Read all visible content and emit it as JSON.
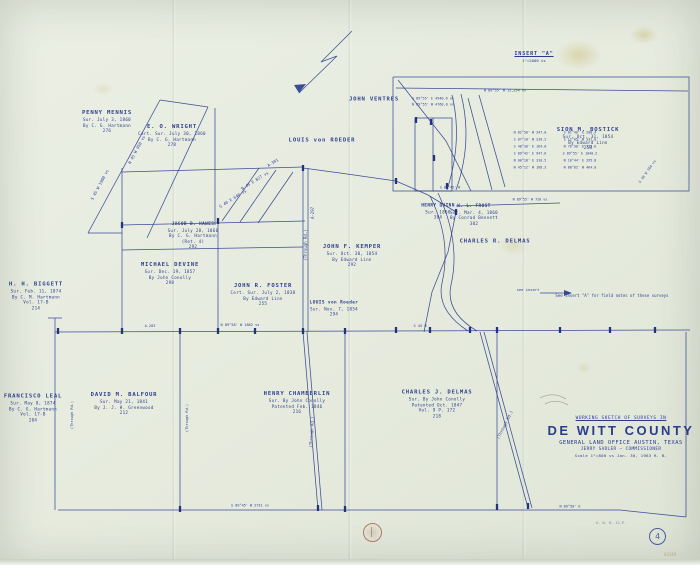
{
  "colors": {
    "paper": "#e8ecdf",
    "ink": "#2e3f8e",
    "red_seal": "#a2543a",
    "stain": "#c4af5f"
  },
  "title_block": {
    "line1": "WORKING SKETCH OF SURVEYS IN",
    "county": "DE WITT  COUNTY",
    "office": "GENERAL LAND OFFICE    AUSTIN, TEXAS",
    "commissioner": "JERRY SADLER — COMMISSIONER",
    "scale_note": "Scale 1\"=800 vs    Jan. 30, 1963    R. B."
  },
  "insert": {
    "label": "INSERT \"A\"",
    "scale": "1\"=2000 vs"
  },
  "footer": {
    "sheet_number": "4",
    "under_border_note": "A. W. B.   12-P.",
    "corner_code": "63249"
  },
  "survey_labels": [
    {
      "x": 107,
      "y": 122,
      "name": "PENNY MENNIS",
      "lines": [
        "Sur. July 3, 1860",
        "By C. G. Hartmann",
        "276"
      ]
    },
    {
      "x": 172,
      "y": 136,
      "name": "E. O. WRIGHT",
      "lines": [
        "Cert. Sur. July 30, 1860",
        "By C. G. Hartmann",
        "278"
      ]
    },
    {
      "x": 193,
      "y": 236,
      "name": "JACOB B. HAWES",
      "lines": [
        "Sur. July 28, 1860",
        "By C. G. Hartmann",
        "(Ret. 4)",
        "292"
      ],
      "small": true
    },
    {
      "x": 170,
      "y": 274,
      "name": "MICHAEL DEVINE",
      "lines": [
        "Sur. Dec. 19, 1857",
        "By John Conolly",
        "298"
      ]
    },
    {
      "x": 263,
      "y": 295,
      "name": "JOHN R. FOSTER",
      "lines": [
        "Cert. Sur. July 2, 1838",
        "By Edward Linn",
        "255"
      ]
    },
    {
      "x": 352,
      "y": 256,
      "name": "JOHN F. KEMPER",
      "lines": [
        "Sur. Oct. 30, 1854",
        "By Edward Linn",
        "292"
      ]
    },
    {
      "x": 322,
      "y": 141,
      "name": "LOUIS von ROEDER",
      "lines": []
    },
    {
      "x": 374,
      "y": 100,
      "name": "JOHN VENTRES",
      "lines": []
    },
    {
      "x": 334,
      "y": 309,
      "name": "LOUIS von Roeder",
      "lines": [
        "Sur. Nov. 7, 1854",
        "294"
      ],
      "small": true
    },
    {
      "x": 36,
      "y": 296,
      "name": "H. H. BIGGETT",
      "lines": [
        "Sur. Feb. 11, 1874",
        "By C. M. Hartmann",
        "Vol. 17-B",
        "214"
      ]
    },
    {
      "x": 33,
      "y": 408,
      "name": "FRANCISCO LEAL",
      "lines": [
        "Sur. May 8, 1874",
        "By C. G. Hartmann",
        "Vol. 17-B",
        "204"
      ]
    },
    {
      "x": 124,
      "y": 404,
      "name": "DAVID M. BALFOUR",
      "lines": [
        "Sur. May 21, 1841",
        "By J. J. H. Greenwood",
        "212"
      ]
    },
    {
      "x": 297,
      "y": 403,
      "name": "HENRY CHAMBERLIN",
      "lines": [
        "Sur. By John Conolly",
        "Patented Feb. 1846",
        "216"
      ]
    },
    {
      "x": 437,
      "y": 404,
      "name": "CHARLES J. DELMAS",
      "lines": [
        "Sur. By John Conolly",
        "Patented Oct. 1847",
        "Vol. 9 P. 172",
        "218"
      ]
    },
    {
      "x": 495,
      "y": 242,
      "name": "CHARLES R. DELMAS",
      "lines": []
    },
    {
      "x": 588,
      "y": 139,
      "name": "SION M. BOSTICK",
      "lines": [
        "Sur. Oct. 31, 1854",
        "By Edward Linn",
        "258"
      ]
    },
    {
      "x": 474,
      "y": 215,
      "name": "W. L. FROST",
      "lines": [
        "Sur. Mar. 4, 1860",
        "By Conrad Bennett",
        "302"
      ],
      "small": true
    },
    {
      "x": 438,
      "y": 212,
      "name": "HENRY QUINN",
      "lines": [
        "Sur. 1860",
        "304"
      ],
      "small": true
    }
  ],
  "micro_labels": [
    {
      "x": 100,
      "y": 185,
      "r": -62,
      "t": "S 45 W 1900 vs"
    },
    {
      "x": 137,
      "y": 150,
      "r": -62,
      "t": "N 45 W 950 vs"
    },
    {
      "x": 233,
      "y": 199,
      "r": -32,
      "t": "S 40 E 640 vs"
    },
    {
      "x": 255,
      "y": 181,
      "r": -32,
      "t": "N 49 E 827 vs"
    },
    {
      "x": 273,
      "y": 163,
      "r": -32,
      "t": "A-301"
    },
    {
      "x": 306,
      "y": 245,
      "r": -90,
      "t": "(Through Rd.)"
    },
    {
      "x": 313,
      "y": 213,
      "r": -90,
      "t": "A-297"
    },
    {
      "x": 240,
      "y": 326,
      "r": 0,
      "t": "N 89°58' W 1862 vs",
      "s": 3.6
    },
    {
      "x": 150,
      "y": 327,
      "r": 0,
      "t": "A-283",
      "s": 3.6
    },
    {
      "x": 420,
      "y": 327,
      "r": 0,
      "t": "S 45 W",
      "s": 3.6
    },
    {
      "x": 312,
      "y": 432,
      "r": -86,
      "t": "(Through Rd.)"
    },
    {
      "x": 505,
      "y": 425,
      "r": -63,
      "t": "(Through Rd.)"
    },
    {
      "x": 73,
      "y": 415,
      "r": -90,
      "t": "(Through Rd.)",
      "s": 3.6
    },
    {
      "x": 188,
      "y": 418,
      "r": -90,
      "t": "(Through Rd.)",
      "s": 3.6
    },
    {
      "x": 433,
      "y": 99,
      "r": 0,
      "t": "S 89°55' E 4940.6 vs",
      "s": 3.5
    },
    {
      "x": 433,
      "y": 105,
      "r": 0,
      "t": "N 89°55' W 4760.0 vs",
      "s": 3.5
    },
    {
      "x": 505,
      "y": 91,
      "r": 0,
      "t": "N 89°55' W 12,354 vs",
      "s": 3.5
    },
    {
      "x": 530,
      "y": 133,
      "r": 0,
      "t": "N 82°50' W 347.0",
      "s": 3.4
    },
    {
      "x": 530,
      "y": 140,
      "r": 0,
      "t": "S 07°10' W 310.2",
      "s": 3.4
    },
    {
      "x": 530,
      "y": 147,
      "r": 0,
      "t": "S 48°30' E 164.0",
      "s": 3.4
    },
    {
      "x": 530,
      "y": 154,
      "r": 0,
      "t": "S 89°42' E 947.6",
      "s": 3.4
    },
    {
      "x": 530,
      "y": 161,
      "r": 0,
      "t": "N 00°18' E 310.5",
      "s": 3.4
    },
    {
      "x": 530,
      "y": 168,
      "r": 0,
      "t": "N 45°12' W 168.3",
      "s": 3.4
    },
    {
      "x": 580,
      "y": 133,
      "r": 0,
      "t": "S 81°40' E 288.4",
      "s": 3.4
    },
    {
      "x": 580,
      "y": 140,
      "r": 0,
      "t": "S 12°05' W 331.0",
      "s": 3.4
    },
    {
      "x": 580,
      "y": 147,
      "r": 0,
      "t": "N 76°30' E 213.6",
      "s": 3.4
    },
    {
      "x": 580,
      "y": 154,
      "r": 0,
      "t": "S 89°55' E 1040.2",
      "s": 3.4
    },
    {
      "x": 580,
      "y": 161,
      "r": 0,
      "t": "N 10°44' E 295.8",
      "s": 3.4
    },
    {
      "x": 580,
      "y": 168,
      "r": 0,
      "t": "N 88°02' W 464.0",
      "s": 3.4
    },
    {
      "x": 648,
      "y": 172,
      "r": -55,
      "t": "S 20 W 164 vs",
      "s": 3.5
    },
    {
      "x": 612,
      "y": 296,
      "r": 0,
      "t": "See insert \"A\" for field notes of these surveys",
      "s": 4
    },
    {
      "x": 528,
      "y": 290,
      "r": 0,
      "t": "see insert",
      "s": 3.8
    },
    {
      "x": 250,
      "y": 506,
      "r": 0,
      "t": "S 89°45' W 2731 vs",
      "s": 3.5
    },
    {
      "x": 570,
      "y": 507,
      "r": 0,
      "t": "N 89°50' E",
      "s": 3.5
    },
    {
      "x": 450,
      "y": 188,
      "r": 0,
      "t": "S 89°45' W",
      "s": 3.4
    },
    {
      "x": 530,
      "y": 200,
      "r": 0,
      "t": "N 89°55' W 720 vs",
      "s": 3.4
    }
  ],
  "map": {
    "polylines": [
      [
        393,
        77,
        689,
        77,
        689,
        191,
        393,
        191,
        393,
        77
      ],
      [
        396,
        88,
        688,
        91
      ],
      [
        398,
        80,
        446,
        141,
        471,
        191
      ],
      [
        415,
        118,
        452,
        118,
        452,
        191,
        415,
        191,
        415,
        118
      ],
      [
        433,
        118,
        433,
        191
      ],
      [
        468,
        98,
        492,
        190
      ],
      [
        479,
        95,
        505,
        187
      ],
      [
        88,
        233,
        160,
        100
      ],
      [
        147,
        238,
        208,
        107
      ],
      [
        160,
        100,
        208,
        107
      ],
      [
        215,
        108,
        215,
        225
      ],
      [
        88,
        233,
        122,
        233
      ],
      [
        122,
        168,
        122,
        332
      ],
      [
        122,
        225,
        305,
        221
      ],
      [
        122,
        250,
        303,
        247
      ],
      [
        218,
        221,
        218,
        332
      ],
      [
        303,
        168,
        303,
        332
      ],
      [
        308,
        168,
        308,
        332
      ],
      [
        122,
        172,
        303,
        167
      ],
      [
        222,
        221,
        259,
        168
      ],
      [
        240,
        222,
        276,
        170
      ],
      [
        258,
        223,
        293,
        172
      ],
      [
        303,
        168,
        340,
        173,
        396,
        181,
        428,
        195,
        456,
        212
      ],
      [
        456,
        212,
        448,
        252,
        432,
        292,
        424,
        332
      ],
      [
        456,
        206,
        560,
        203
      ],
      [
        55,
        318,
        55,
        510
      ],
      [
        55,
        332,
        690,
        330
      ],
      [
        58,
        510,
        620,
        510
      ],
      [
        620,
        510,
        686,
        517
      ],
      [
        686,
        517,
        686,
        332
      ],
      [
        180,
        332,
        180,
        510
      ],
      [
        345,
        332,
        345,
        510
      ],
      [
        497,
        332,
        497,
        508
      ],
      [
        303,
        332,
        318,
        510
      ],
      [
        307,
        332,
        322,
        510
      ],
      [
        480,
        332,
        528,
        508
      ],
      [
        484,
        332,
        532,
        508
      ],
      [
        48,
        318,
        62,
        318
      ],
      [
        352,
        31,
        321,
        62,
        337,
        56,
        299,
        93
      ],
      [
        540,
        293,
        570,
        293
      ]
    ],
    "curves": [
      {
        "d": "M430,196 Q452,240 442,283 Q436,310 468,331"
      },
      {
        "d": "M438,193 Q461,242 451,285 Q445,312 477,331"
      },
      {
        "d": "M452,95 Q463,140 447,190"
      },
      {
        "d": "M461,94 Q473,142 456,190"
      },
      {
        "d": "M299,93 L306,84 L294,85 Z",
        "cls": "fill"
      },
      {
        "d": "M572,293 L564,290 L564,296 Z",
        "cls": "fill"
      },
      {
        "d": "M540,398 Q553,391 566,399",
        "cls": "pencil"
      },
      {
        "d": "M545,404 Q556,398 568,405",
        "cls": "pencil"
      }
    ],
    "ticks": [
      [
        58,
        331
      ],
      [
        122,
        331
      ],
      [
        180,
        331
      ],
      [
        218,
        331
      ],
      [
        255,
        331
      ],
      [
        303,
        331
      ],
      [
        345,
        331
      ],
      [
        396,
        330
      ],
      [
        430,
        330
      ],
      [
        470,
        330
      ],
      [
        497,
        330
      ],
      [
        560,
        330
      ],
      [
        610,
        330
      ],
      [
        655,
        330
      ],
      [
        431,
        122
      ],
      [
        434,
        158
      ],
      [
        447,
        186
      ],
      [
        416,
        120
      ],
      [
        122,
        225
      ],
      [
        218,
        221
      ],
      [
        303,
        168
      ],
      [
        456,
        212
      ],
      [
        396,
        181
      ],
      [
        180,
        509
      ],
      [
        345,
        509
      ],
      [
        497,
        507
      ],
      [
        318,
        508
      ],
      [
        528,
        506
      ]
    ]
  }
}
